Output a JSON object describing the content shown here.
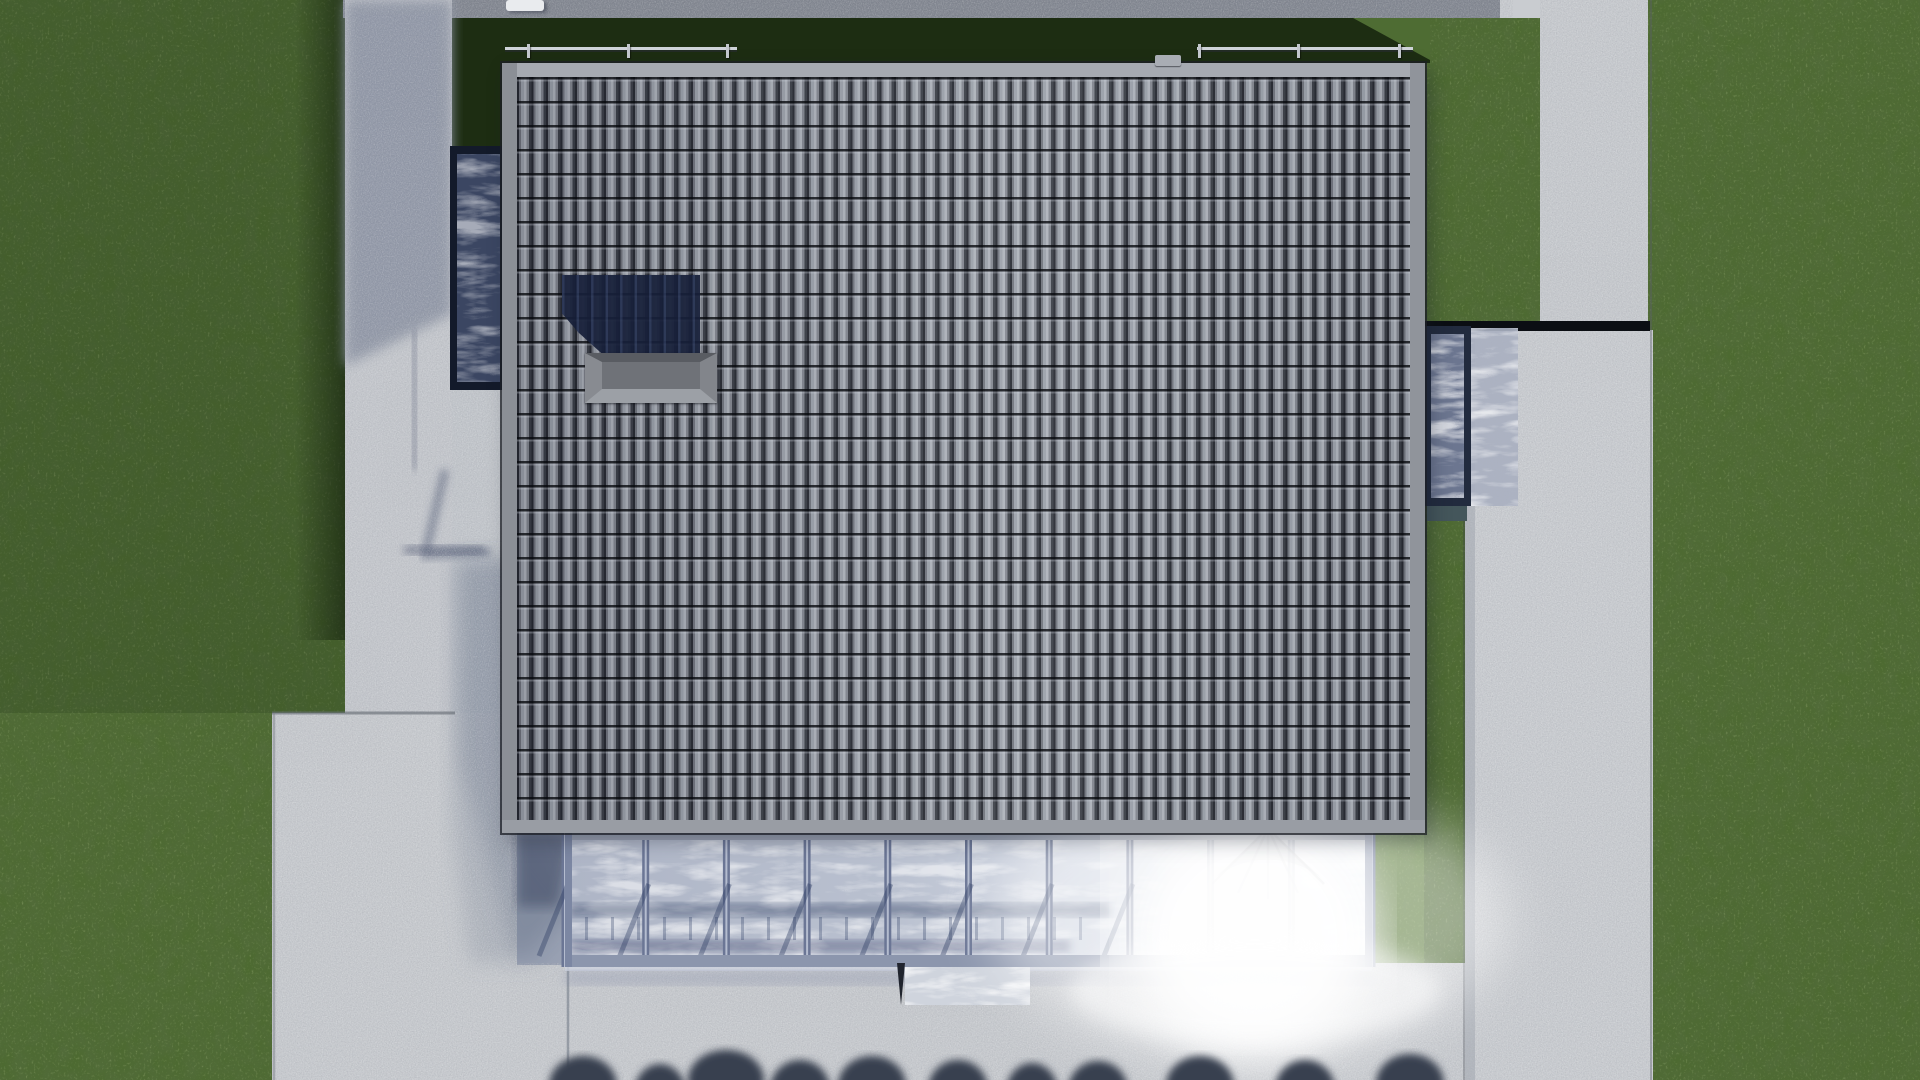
{
  "scene": {
    "title": "aerial-house-render",
    "description": "Top-down 3D architectural rendering of a house with gray barrel-tile roof, roof hatch, skylight, glass bay, glass canopy with sun glare, concrete paths and patio, surrounded by lawn and a row of bushes",
    "view": "top-down"
  },
  "palette": {
    "grass_base": "#4d6a31",
    "grass_shadow_band": "#1d2d12",
    "grass_sunlit": "#57783a",
    "concrete_light": "#c9ccd0",
    "concrete_shadow": "#8e95a5",
    "path_top_shadow": "#7e838d",
    "roof_fascia": "#93979e",
    "roof_tile_light": "#adb2ba",
    "roof_tile_dark": "#262931",
    "chimney_shadow": "#17203a",
    "hatch_cap": "#6f7278",
    "frame_navy": "#131a2a",
    "skylight_glass": "#3b4662",
    "bay_glass": "#6c7690",
    "canopy_glass": "#b9c0cf",
    "canopy_mullion": "#6b7695",
    "canopy_shadow_band": "rgba(40,55,95,0.38)",
    "glare_white": "#ffffff",
    "bush_silhouette": "#394050",
    "expansion_gap_black": "#0b0e13",
    "railing": "#cfd3d9",
    "bay_under_shadow": "#44565b"
  },
  "canopy": {
    "x": 565,
    "y": 833,
    "w": 807,
    "h": 134,
    "panels": 10,
    "mullion_w": 7,
    "diag_shadow_count": 8,
    "tick_y1": 917,
    "tick_y2": 940,
    "tick_from_x": 585,
    "tick_to_x": 1085,
    "tick_step": 26
  },
  "bushes": [
    {
      "cx": 583,
      "rx": 34,
      "top": 1058
    },
    {
      "cx": 660,
      "rx": 26,
      "top": 1066
    },
    {
      "cx": 726,
      "rx": 38,
      "top": 1052
    },
    {
      "cx": 800,
      "rx": 30,
      "top": 1062
    },
    {
      "cx": 872,
      "rx": 34,
      "top": 1058
    },
    {
      "cx": 958,
      "rx": 30,
      "top": 1062
    },
    {
      "cx": 1032,
      "rx": 26,
      "top": 1065
    },
    {
      "cx": 1098,
      "rx": 30,
      "top": 1063
    },
    {
      "cx": 1200,
      "rx": 34,
      "top": 1058
    },
    {
      "cx": 1305,
      "rx": 30,
      "top": 1062
    },
    {
      "cx": 1410,
      "rx": 34,
      "top": 1056
    }
  ],
  "railings": [
    {
      "x1": 505,
      "x2": 737,
      "posts": [
        527,
        627,
        726
      ]
    },
    {
      "x1": 1197,
      "x2": 1413,
      "posts": [
        1198,
        1297,
        1398
      ]
    }
  ]
}
